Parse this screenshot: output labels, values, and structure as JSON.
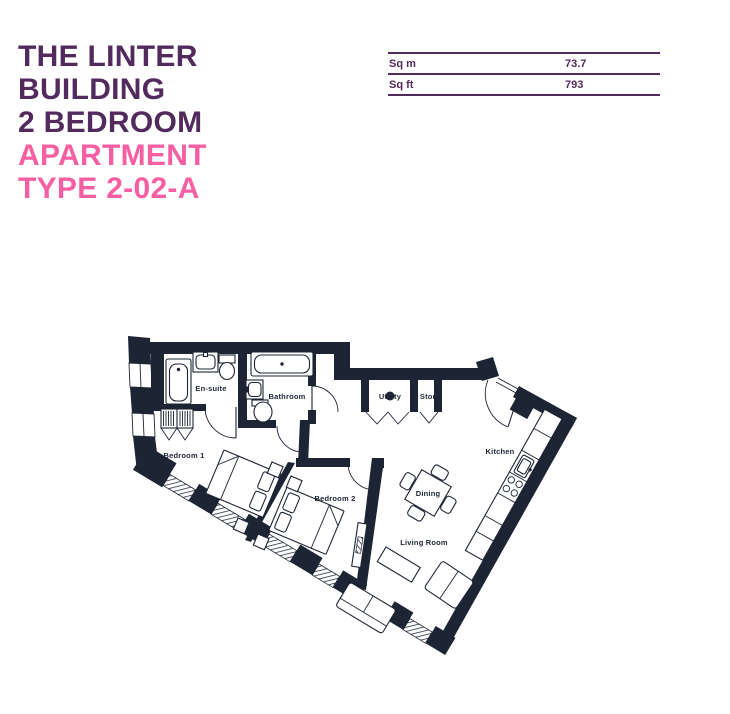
{
  "header": {
    "building_lines": [
      "THE LINTER",
      "BUILDING",
      "2 BEDROOM"
    ],
    "type_lines": [
      "APARTMENT",
      "TYPE 2-02-A"
    ]
  },
  "area_table": {
    "rows": [
      {
        "label": "Sq m",
        "value": "73.7"
      },
      {
        "label": "Sq ft",
        "value": "793"
      }
    ]
  },
  "floorplan": {
    "labels": {
      "ensuite": "En-suite",
      "bathroom": "Bathroom",
      "bedroom1": "Bedroom 1",
      "bedroom2": "Bedroom 2",
      "utility": "Utility",
      "store": "Store",
      "kitchen": "Kitchen",
      "dining": "Dining",
      "living_room": "Living Room"
    }
  },
  "colors": {
    "title_purple": "#522a5e",
    "accent_pink": "#f65fa2",
    "plan_ink": "#1d2433",
    "background": "#ffffff"
  }
}
